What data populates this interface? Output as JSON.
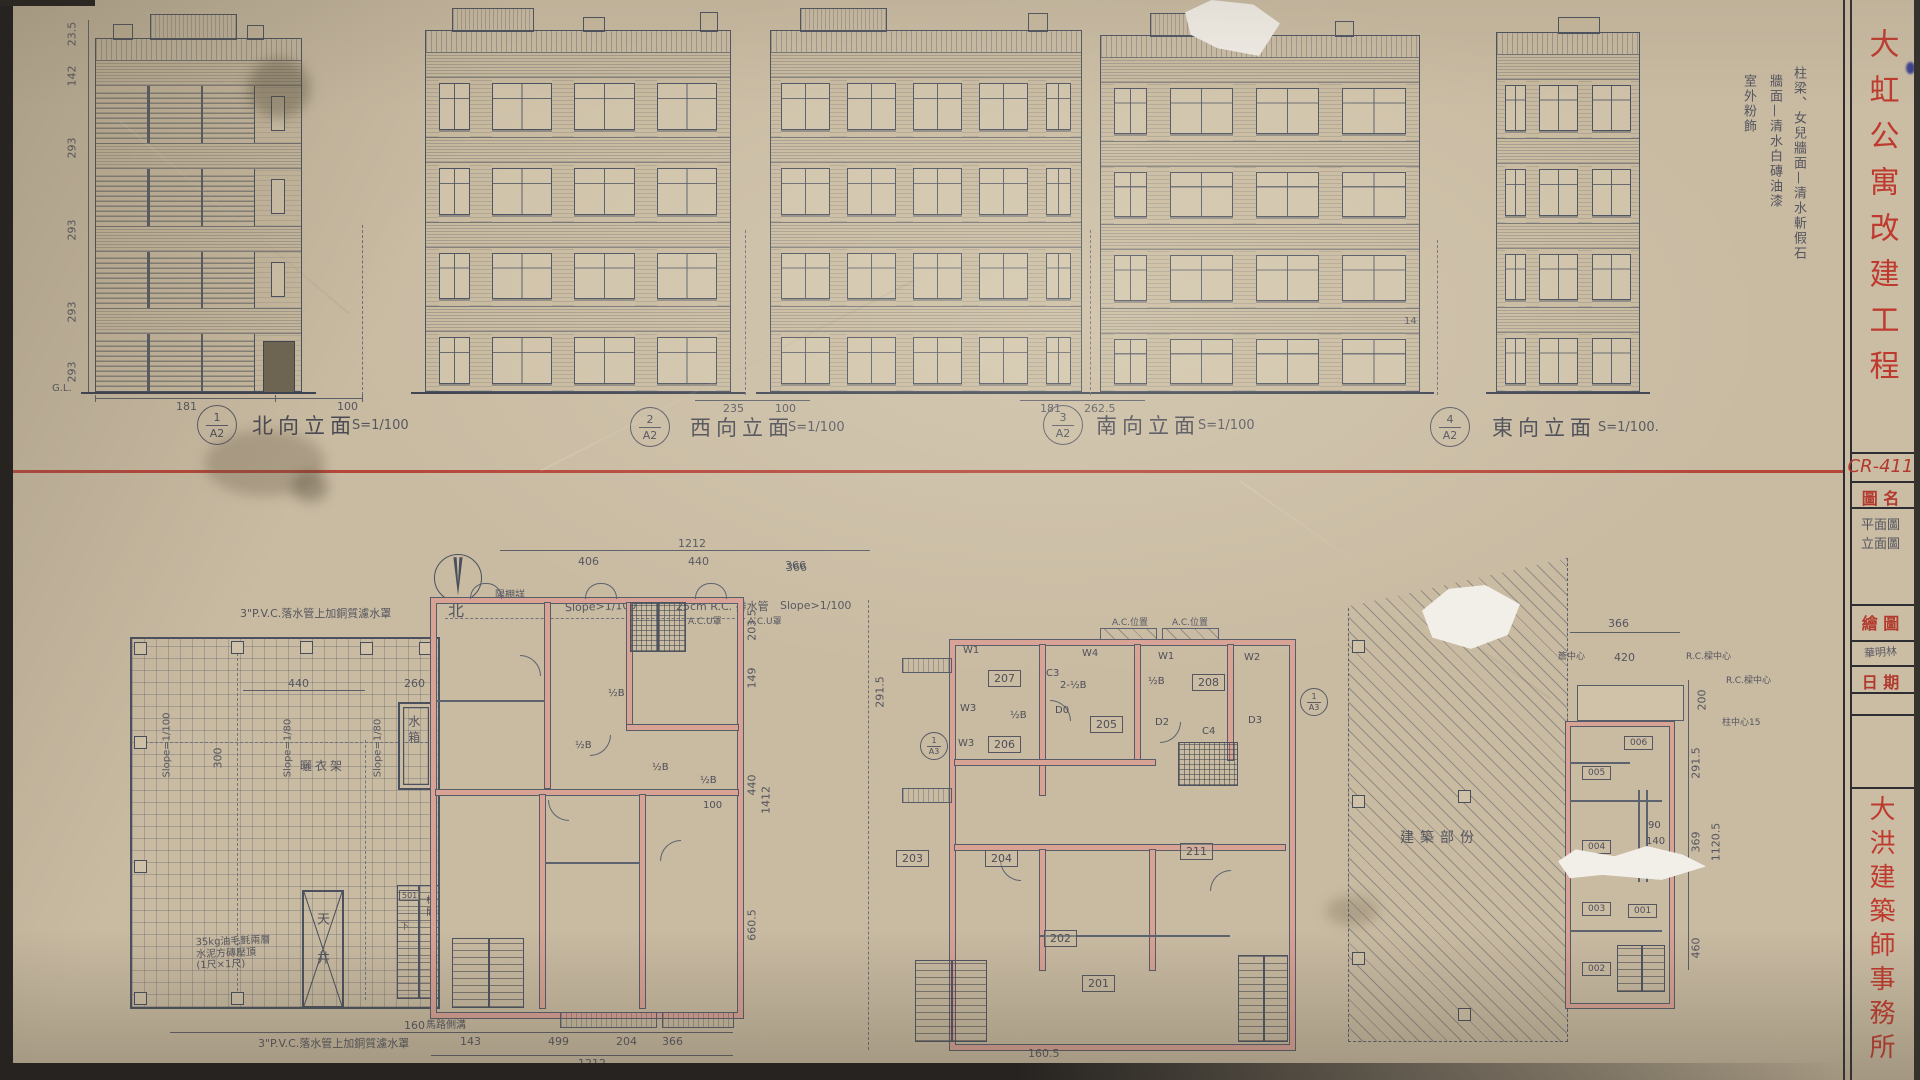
{
  "titleblock": {
    "project": "大虹公寓改建工程",
    "drawing_no": "CR-411",
    "name_label": "圖 名",
    "name_value": "平面圖\n立面圖",
    "drafter_label": "繪 圖",
    "drafter_value": "華明林",
    "date_label": "日 期",
    "office": "大洪建築師事務所"
  },
  "finish_note": {
    "line1": "柱梁、女兒牆面—清水斬假石",
    "line2": "牆面—清水白磚油漆",
    "line3": "室外粉飾"
  },
  "elevations": {
    "captions": [
      {
        "num": "1",
        "sheet": "A2",
        "title": "北向立面",
        "scale": "S=1/100"
      },
      {
        "num": "2",
        "sheet": "A2",
        "title": "西向立面",
        "scale": "S=1/100"
      },
      {
        "num": "3",
        "sheet": "A2",
        "title": "南向立面",
        "scale": "S=1/100"
      },
      {
        "num": "4",
        "sheet": "A2",
        "title": "東向立面",
        "scale": "S=1/100."
      }
    ],
    "left_dims": [
      "23.5",
      "142",
      "293",
      "293",
      "293",
      "293"
    ],
    "ground_label": "G.L.",
    "site_dims": {
      "d1": "181",
      "d2": "100",
      "d3": "235",
      "d4": "100",
      "d5": "181",
      "d6": "262.5",
      "d7": "14"
    }
  },
  "plans": {
    "north_arrow_label": "北",
    "roof": {
      "pvc_note_top": "3\"P.V.C.落水管上加銅質濾水罩",
      "pvc_note_bottom": "3\"P.V.C.落水管上加銅質濾水罩",
      "membrane_note": "35kg油毛氈兩層\n水泥方磚壓頂\n(1尺×1尺)",
      "slope_100": "Slope=1/100",
      "slope_80a": "Slope=1/80",
      "slope_80b": "Slope=1/80",
      "dim_440": "440",
      "dim_260": "260",
      "dim_300": "300",
      "dim_160": "160",
      "water_tank": "水箱",
      "drying_rack": "曬衣架",
      "light_well": "天井",
      "stair_room_no": "501",
      "stair_label": "梯間",
      "down_label": "下"
    },
    "typical": {
      "dims_top": [
        "1212",
        "406",
        "440",
        "366"
      ],
      "dims_bottom": [
        "143",
        "499",
        "204",
        "366",
        "1212"
      ],
      "dims_right": [
        "203.5",
        "149",
        "440",
        "660.5",
        "1412"
      ],
      "slope_note": "Slope>1/100",
      "drain_note": "25cm R.C. 排水管",
      "ac_note": "A.C.U罩",
      "awning_note": "陽棚詳",
      "wall_label": "½B",
      "dim_100": "100",
      "road_note": "馬路側溝"
    },
    "second": {
      "rooms": [
        "201",
        "202",
        "203",
        "204",
        "205",
        "206",
        "207",
        "208",
        "211"
      ],
      "window_marks": [
        "W1",
        "W2",
        "W3",
        "W3",
        "W4"
      ],
      "door_marks": [
        "D0",
        "D2",
        "D3"
      ],
      "column_marks": [
        "C3",
        "C4"
      ],
      "wall_label": "½B",
      "wall_label2": "2-½B",
      "ac_note": "A.C.位置",
      "section_num": "1",
      "section_sheet": "A3",
      "dim_2915": "291.5",
      "dim_1605": "160.5",
      "dim_366": "366",
      "slope_note": "Slope>1/100"
    },
    "ground": {
      "area_label": "建築部份",
      "rooms": [
        "001",
        "002",
        "003",
        "004",
        "005",
        "006"
      ],
      "dims_right": [
        "200",
        "291.5",
        "369",
        "460",
        "1120.5"
      ],
      "dims_top": [
        "366",
        "420"
      ],
      "dim_90": "90",
      "dim_140": "140",
      "note1": "簷中心",
      "note2": "R.C.樑中心",
      "note3": "R.C.樑中心",
      "note4": "柱中心15"
    }
  }
}
